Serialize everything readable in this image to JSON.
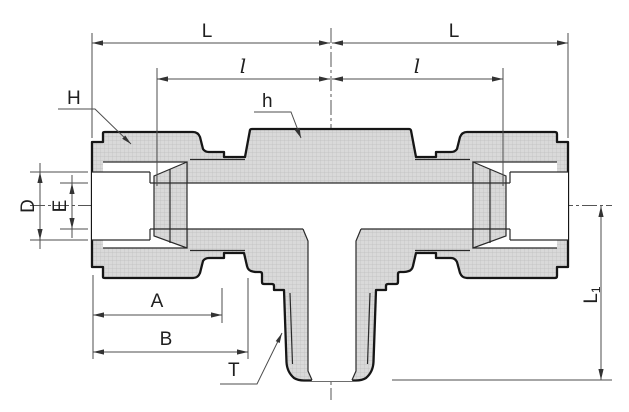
{
  "drawing": {
    "title": "tee-fitting-section-drawing",
    "labels": {
      "dim_L_left": "L",
      "dim_L_right": "L",
      "dim_l_left": "l",
      "dim_l_right": "l",
      "leader_H": "H",
      "leader_h": "h",
      "leader_T": "T",
      "dim_D": "D",
      "dim_E": "E",
      "dim_A": "A",
      "dim_B": "B",
      "dim_L1_main": "L",
      "dim_L1_sub": "1"
    },
    "colors": {
      "outline": "#161616",
      "dimension_lines": "#4d4d4d",
      "section_fill": "#d9d9d9",
      "background": "#ffffff"
    }
  }
}
